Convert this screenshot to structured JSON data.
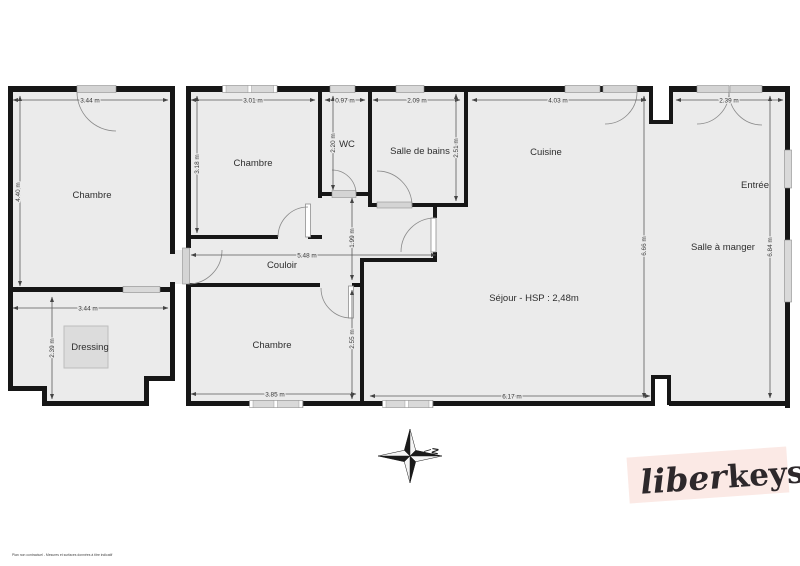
{
  "colors": {
    "room_fill": "#ebebeb",
    "wall": "#161616",
    "window": "#d9d9d9",
    "dimension": "#5a5a5a",
    "text": "#2e2e2e",
    "logo_background": "#fbe9e5",
    "logo_text": "#2d282b",
    "closet": "#dcdcdc"
  },
  "rooms": {
    "chambre1": {
      "label": "Chambre",
      "width": "3.44 m",
      "height": "4.40 m"
    },
    "chambre2": {
      "label": "Chambre",
      "width": "3.01 m",
      "height": "3.18 m"
    },
    "wc": {
      "label": "WC",
      "width": "0.97 m",
      "height": "2.20 m"
    },
    "salle_de_bains": {
      "label": "Salle de bains",
      "width": "2.09 m",
      "height": "2.51 m"
    },
    "cuisine": {
      "label": "Cuisine",
      "width": "4.03 m"
    },
    "sejour": {
      "label": "Séjour - HSP : 2,48m",
      "width": "6.17 m",
      "height": "6.66 m"
    },
    "couloir": {
      "label": "Couloir",
      "width": "5.48 m",
      "height": "1.99 m"
    },
    "chambre3": {
      "label": "Chambre",
      "width": "3.85 m",
      "height": "2.55 m"
    },
    "dressing": {
      "label": "Dressing",
      "width": "3.44 m",
      "height": "2.39 m"
    },
    "entree": {
      "label": "Entrée",
      "width": "2.39 m"
    },
    "salle_a_manger": {
      "label": "Salle à manger",
      "height": "6.84 m"
    }
  },
  "compass": {
    "north": "N"
  },
  "logo": {
    "script": "liber",
    "bold": "keys"
  },
  "footer": {
    "disclaimer": "Plan non contractuel - Mesures et surfaces données à titre indicatif"
  }
}
